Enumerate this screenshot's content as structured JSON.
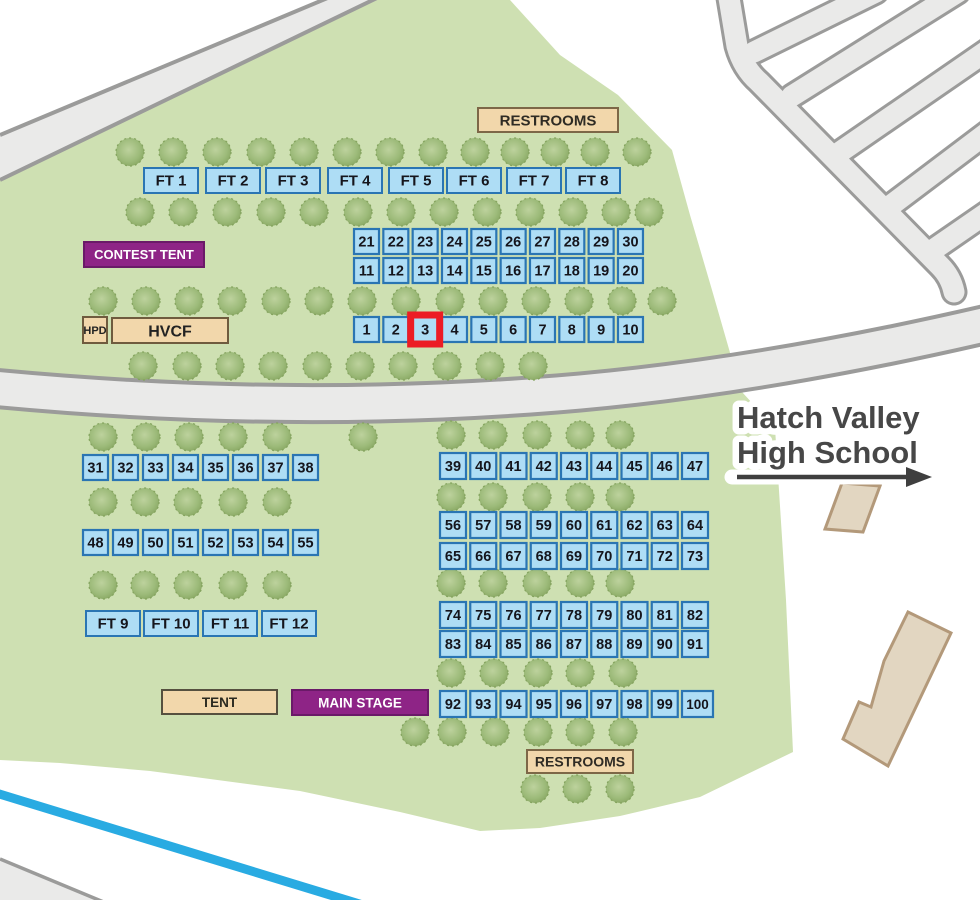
{
  "map": {
    "school": {
      "line1": "Hatch Valley",
      "line2": "High School"
    },
    "labels": {
      "restrooms_top": "RESTROOMS",
      "restrooms_bottom": "RESTROOMS",
      "contest_tent": "CONTEST TENT",
      "hpd": "HPD",
      "hvcf": "HVCF",
      "tent": "TENT",
      "main_stage": "MAIN STAGE"
    },
    "food_tents_top": [
      "FT 1",
      "FT 2",
      "FT 3",
      "FT 4",
      "FT 5",
      "FT 6",
      "FT 7",
      "FT 8"
    ],
    "food_tents_bottom": [
      "FT 9",
      "FT 10",
      "FT 11",
      "FT 12"
    ],
    "booth_rows": [
      {
        "id": "booths-21-30",
        "numbers": [
          "21",
          "22",
          "23",
          "24",
          "25",
          "26",
          "27",
          "28",
          "29",
          "30"
        ]
      },
      {
        "id": "booths-11-20",
        "numbers": [
          "11",
          "12",
          "13",
          "14",
          "15",
          "16",
          "17",
          "18",
          "19",
          "20"
        ]
      },
      {
        "id": "booths-1-10",
        "numbers": [
          "1",
          "2",
          "3",
          "4",
          "5",
          "6",
          "7",
          "8",
          "9",
          "10"
        ]
      },
      {
        "id": "booths-31-38",
        "numbers": [
          "31",
          "32",
          "33",
          "34",
          "35",
          "36",
          "37",
          "38"
        ]
      },
      {
        "id": "booths-48-55",
        "numbers": [
          "48",
          "49",
          "50",
          "51",
          "52",
          "53",
          "54",
          "55"
        ]
      },
      {
        "id": "booths-39-47",
        "numbers": [
          "39",
          "40",
          "41",
          "42",
          "43",
          "44",
          "45",
          "46",
          "47"
        ]
      },
      {
        "id": "booths-56-64",
        "numbers": [
          "56",
          "57",
          "58",
          "59",
          "60",
          "61",
          "62",
          "63",
          "64"
        ]
      },
      {
        "id": "booths-65-73",
        "numbers": [
          "65",
          "66",
          "67",
          "68",
          "69",
          "70",
          "71",
          "72",
          "73"
        ]
      },
      {
        "id": "booths-74-82",
        "numbers": [
          "74",
          "75",
          "76",
          "77",
          "78",
          "79",
          "80",
          "81",
          "82"
        ]
      },
      {
        "id": "booths-83-91",
        "numbers": [
          "83",
          "84",
          "85",
          "86",
          "87",
          "88",
          "89",
          "90",
          "91"
        ]
      },
      {
        "id": "booths-92-100",
        "numbers": [
          "92",
          "93",
          "94",
          "95",
          "96",
          "97",
          "98",
          "99",
          "100"
        ]
      }
    ],
    "highlighted_booth": {
      "row": "booths-1-10",
      "number": "3"
    },
    "colors": {
      "grounds_green": "#cee0b2",
      "tree_green": "#9cba79",
      "road_fill": "#eaeae9",
      "road_border": "#9b9b9a",
      "booth_fill": "#aeddf5",
      "booth_border": "#2a75b3",
      "highlight_red": "#ec1c24",
      "tan_fill": "#f2d7ab",
      "tan_border": "#6f5b3e",
      "purple": "#8e2486",
      "purple_border": "#6a1a68",
      "river_blue": "#29abe2",
      "building_fill": "#e2d6c1",
      "building_border": "#b3997a",
      "text_dark": "#474747"
    }
  }
}
